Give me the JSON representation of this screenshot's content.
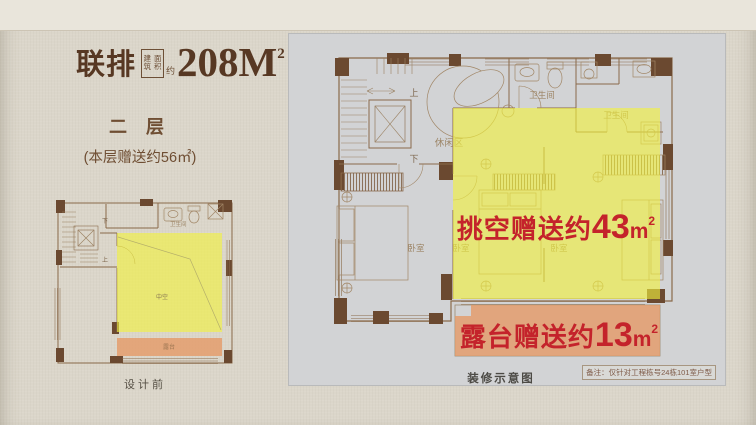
{
  "poster": {
    "header": {
      "type_label": "联排",
      "area_box_col1": "建筑",
      "area_box_col2": "面积",
      "area_approx_label": "约",
      "area_value": "208M",
      "area_exponent": "2",
      "floor_label": "二 层",
      "floor_bonus_note": "(本层赠送约56㎡)"
    },
    "before_plan": {
      "caption": "设计前",
      "labels": {
        "bathroom": "卫生间",
        "down": "下",
        "up": "上",
        "void": "中空",
        "terrace": "露台"
      }
    },
    "after_plan": {
      "caption": "装修示意图",
      "disclaimer": "备注：仅针对工程栋号24栋101室户型",
      "labels": {
        "up": "上",
        "down": "下",
        "leisure_area": "休闲区",
        "bathroom_top": "卫生间",
        "bathroom_right": "卫生间",
        "bedroom_left": "卧室",
        "bedroom_mid": "卧室",
        "bedroom_right": "卧室"
      },
      "callouts": {
        "void_gift": {
          "prefix": "挑空赠送约",
          "value": "43",
          "unit": "m",
          "exponent": "2"
        },
        "terrace_gift": {
          "prefix": "露台赠送约",
          "value": "13",
          "unit": "m",
          "exponent": "2"
        }
      }
    },
    "colors": {
      "accent_red": "#c4232b",
      "highlight_yellow": "#e3e479",
      "highlight_terrace": "#dfb08c",
      "wall_brown": "#6b4930",
      "title_brown": "#573823",
      "panel_gray": "#d2d3d5",
      "page_beige": "#dbd6ca"
    }
  }
}
